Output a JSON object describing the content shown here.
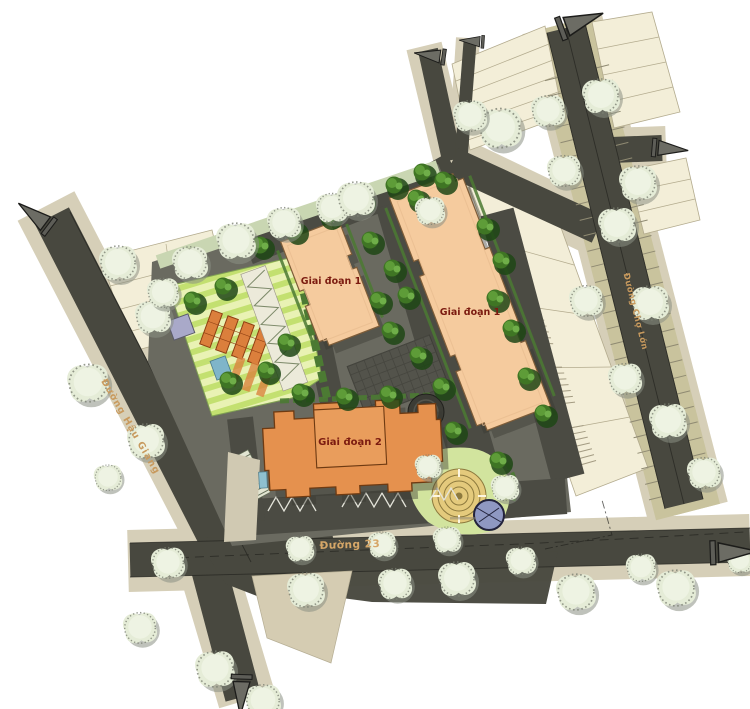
{
  "map": {
    "type": "site-master-plan",
    "building_labels": {
      "phase1_a": "Giai đoạn 1",
      "phase1_b": "Giai đoạn 1",
      "phase2": "Giai đoạn 2"
    },
    "street_labels": {
      "hau_giang": "Đường Hậu Giang",
      "cho_lon": "Đường Chợ Lớn",
      "street_23": "Đường 23"
    },
    "colors": {
      "road": "#48483f",
      "walk": "#d6cfb8",
      "khaki": "#c9c39d",
      "parcel": "#f3eed8",
      "parcelline": "#b3ab8e",
      "site": "#6a6a60",
      "drive": "#4b4b43",
      "plaza": "#53534b",
      "bldg1": "#f5cb9e",
      "bldg1edge": "#7d5c38",
      "bldg2": "#e5914e",
      "bldg2edge": "#6e3a12",
      "treesage": "#e5ecd7",
      "treesagehi": "#eef3e3",
      "treesageshadow": "#8b8f83",
      "treedark": "#3f7524",
      "treedarkhi": "#5e9c38",
      "hedge": "#c9d6b2",
      "hedgedark": "#4c7a33",
      "stripea": "#c3e070",
      "stripeb": "#e9f2b4",
      "pergola": "#db7f3c",
      "lawn": "#d2e49e",
      "labyrinth": "#e4ca7c",
      "labyrinthline": "#8d7a3e",
      "pool": "#8f98c2",
      "lblbldg": "#7b1b10",
      "lblstreet": "#c89a5e",
      "arrowfill": "#6c6c64",
      "lineblack": "#22221e"
    }
  }
}
